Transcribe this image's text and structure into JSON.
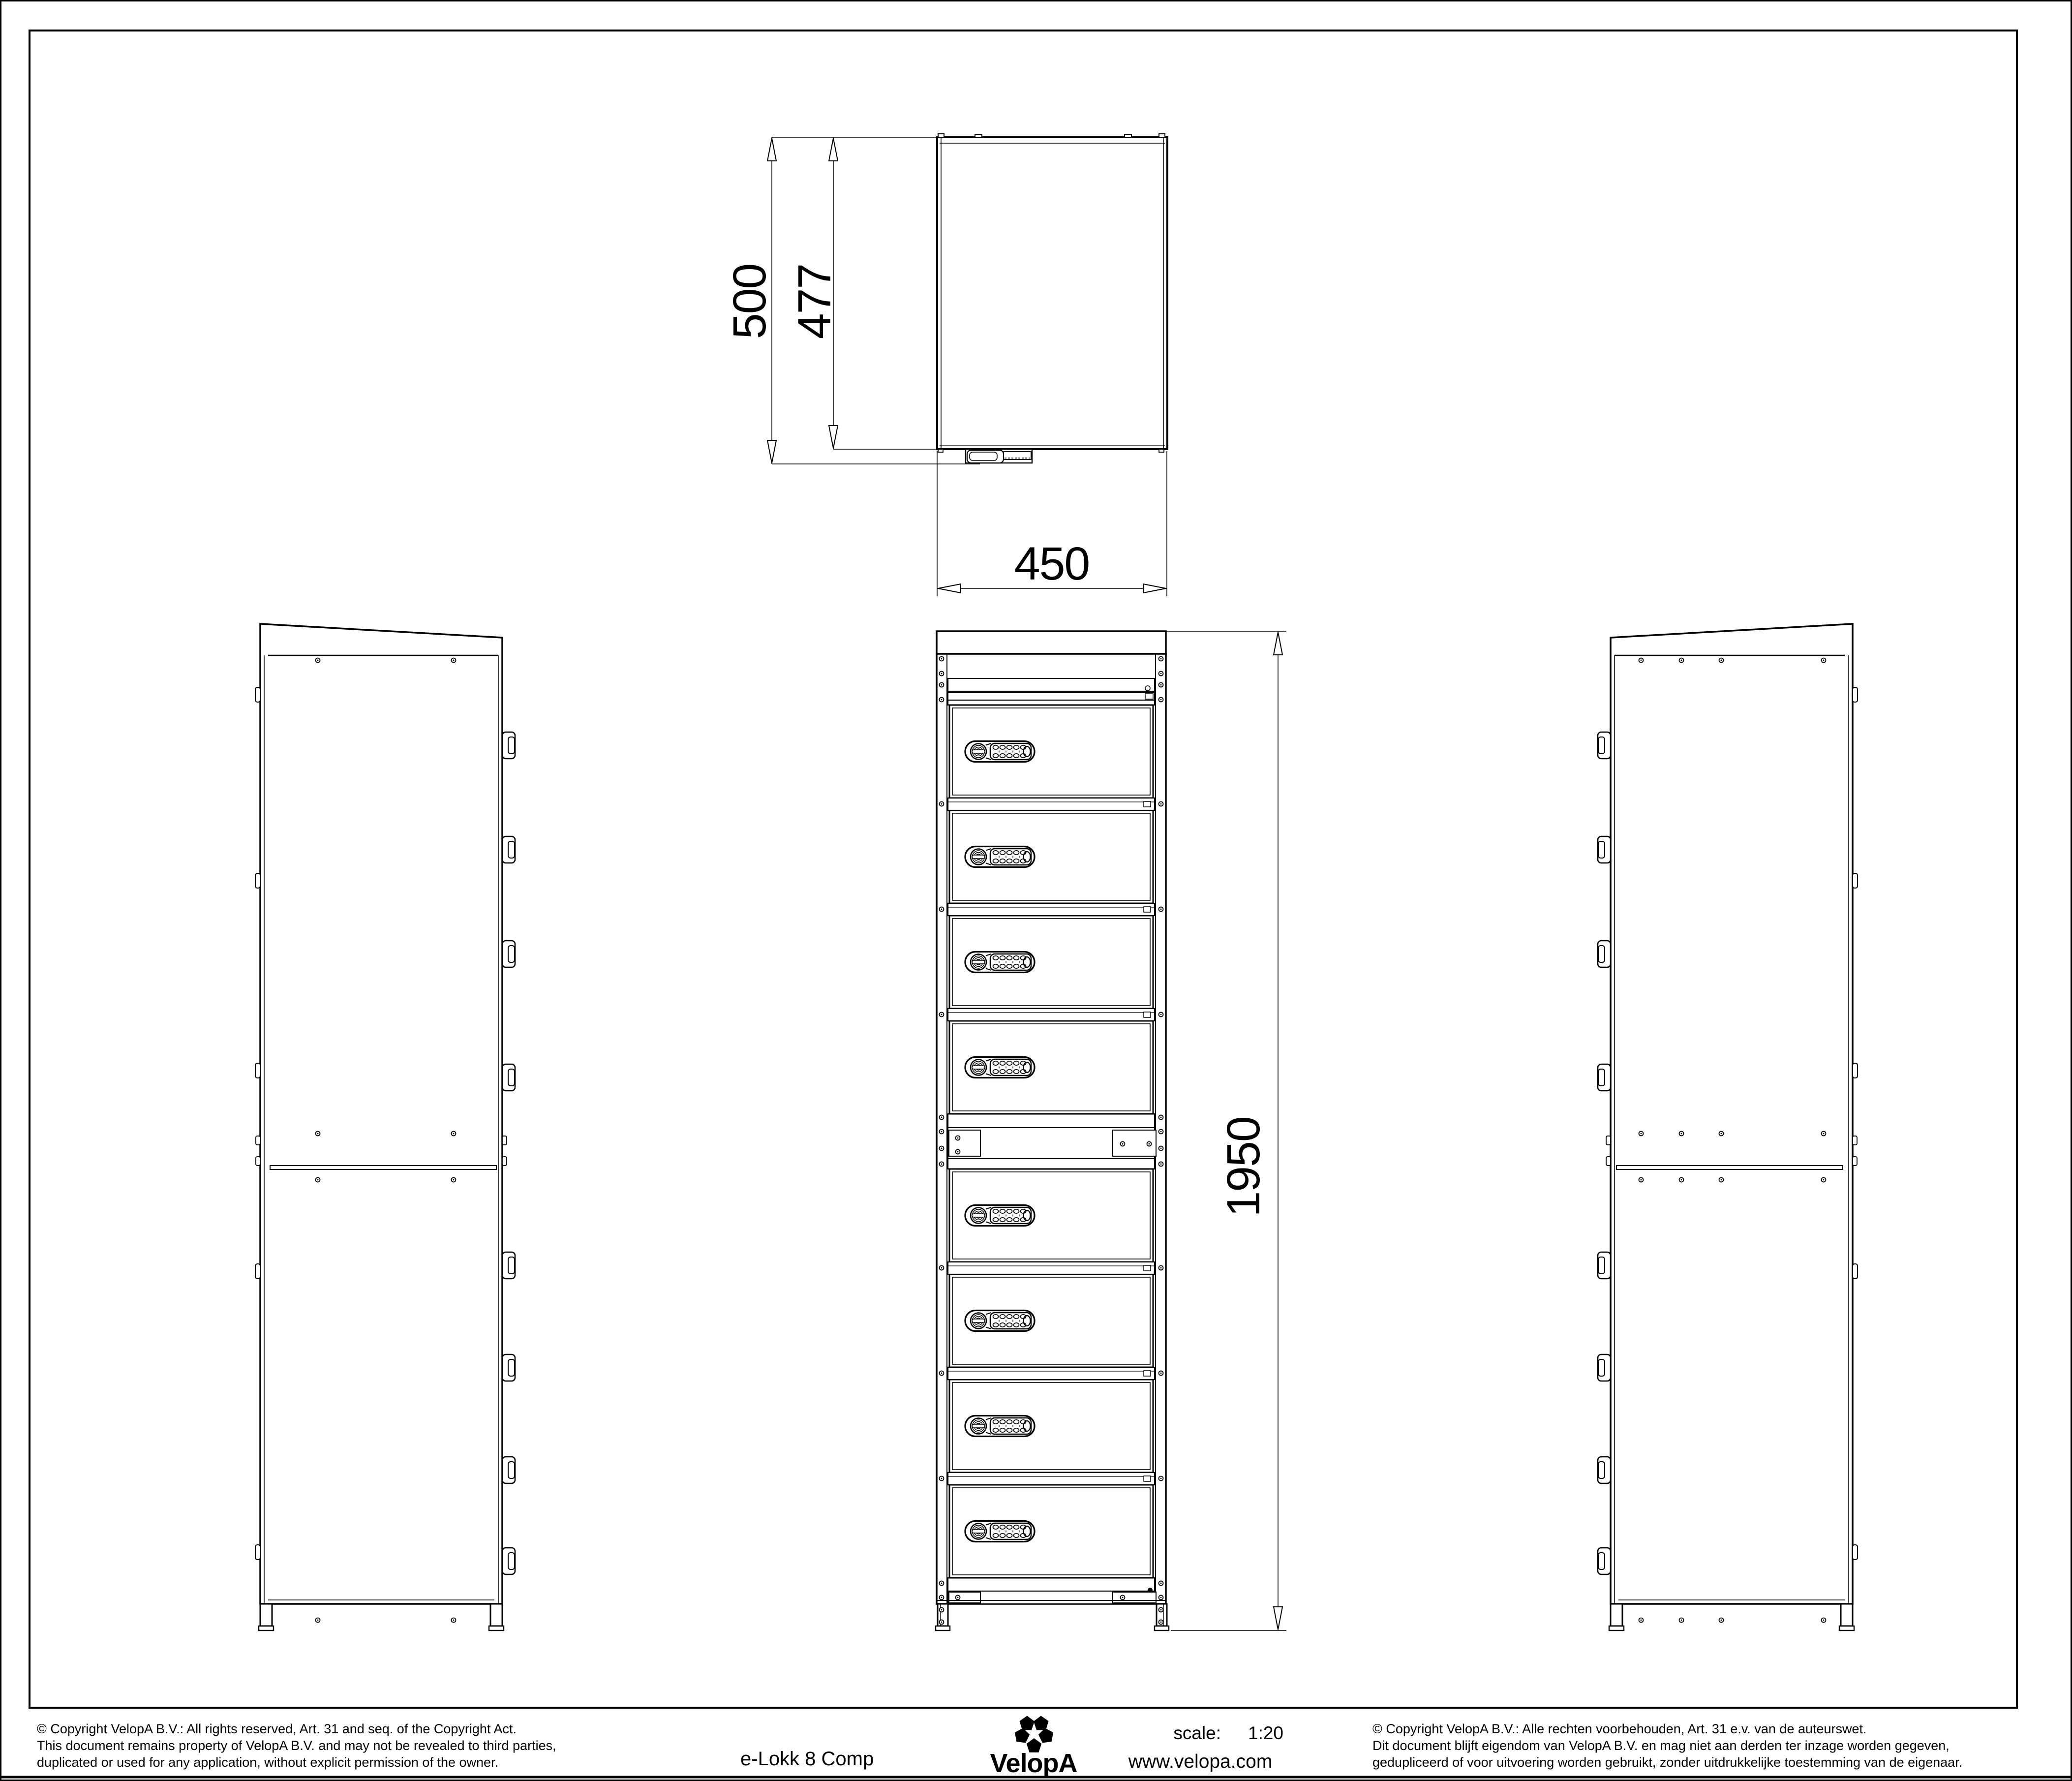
{
  "page": {
    "background": "#ffffff",
    "line_color": "#000000"
  },
  "title_block": {
    "title": "e-Lokk 8 Comp",
    "scale_label": "scale:",
    "scale_value": "1:20",
    "website": "www.velopa.com",
    "brand": "VelopA"
  },
  "dimensions": {
    "depth_total": "500",
    "depth_inner": "477",
    "width": "450",
    "height": "1950"
  },
  "drawing": {
    "compartment_count": 8,
    "views": [
      "top-view",
      "side-view-left",
      "front-view",
      "side-view-right"
    ],
    "doors_above_junction": 4,
    "doors_below_junction": 4
  },
  "icons": {
    "keypad_lock": "pill-shaped keypad lock with round cam lock and 2x5 button grid",
    "logo": "velopa-five-petal-flower"
  },
  "copyright": {
    "en": [
      "©  Copyright VelopA B.V.: All rights reserved, Art. 31 and seq. of the Copyright Act.",
      "This document remains property of VelopA B.V. and may not be revealed to third parties,",
      "duplicated or used for any application, without explicit permission of the owner."
    ],
    "nl": [
      "©  Copyright VelopA B.V.: Alle rechten voorbehouden, Art. 31 e.v. van de auteurswet.",
      "Dit document blijft eigendom van VelopA B.V. en mag niet aan derden ter inzage worden gegeven,",
      "gedupliceerd of voor uitvoering worden gebruikt, zonder uitdrukkelijke toestemming van de eigenaar."
    ]
  }
}
